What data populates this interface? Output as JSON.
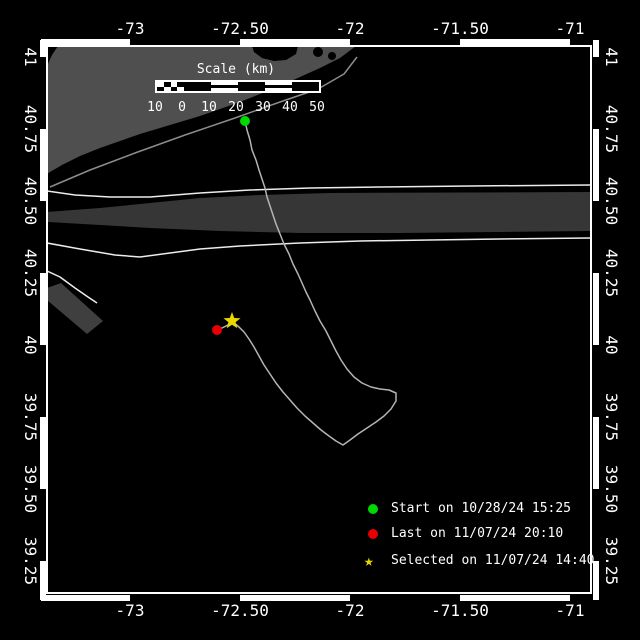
{
  "window": {
    "background": "#000000"
  },
  "colors": {
    "frame": "#ffffff",
    "text": "#ffffff",
    "land": "#4f4f4f",
    "coast_line": "#8c8c8c",
    "lane_band": "#363636",
    "approach_wedge": "#3f3f3f",
    "lane_line": "#ececec",
    "track": "#b4b4b4",
    "start": "#00d800",
    "last": "#e60000",
    "selected": "#e8d800"
  },
  "axes": {
    "lon_ticks": [
      {
        "label": "-73",
        "x": 130
      },
      {
        "label": "-72.50",
        "x": 240
      },
      {
        "label": "-72",
        "x": 350
      },
      {
        "label": "-71.50",
        "x": 460
      },
      {
        "label": "-71",
        "x": 570
      }
    ],
    "lat_ticks": [
      {
        "label": "41",
        "y": 57
      },
      {
        "label": "40.75",
        "y": 129
      },
      {
        "label": "40.50",
        "y": 201
      },
      {
        "label": "40.25",
        "y": 273
      },
      {
        "label": "40",
        "y": 345
      },
      {
        "label": "39.75",
        "y": 417
      },
      {
        "label": "39.50",
        "y": 489
      },
      {
        "label": "39.25",
        "y": 561
      }
    ],
    "zebra": {
      "lon_white": [
        [
          41,
          130
        ],
        [
          240,
          350
        ],
        [
          460,
          570
        ]
      ],
      "lat_white": [
        [
          40,
          57
        ],
        [
          129,
          201
        ],
        [
          273,
          345
        ],
        [
          417,
          489
        ],
        [
          561,
          600
        ]
      ]
    }
  },
  "scalebar": {
    "title": "Scale (km)",
    "x": 155,
    "title_y": 63,
    "bar_y": 80,
    "bar_h": 13,
    "seg_w": 27,
    "segments": [
      "checker",
      "black",
      "striped",
      "black",
      "striped",
      "black"
    ],
    "labels": [
      "10",
      "0",
      "10",
      "20",
      "30",
      "40",
      "50"
    ],
    "labels_y": 101
  },
  "legend": {
    "marker_x": 373,
    "label_x": 391,
    "items": [
      {
        "marker": "circle",
        "color_key": "start",
        "label": "Start on 10/28/24 15:25",
        "y": 509
      },
      {
        "marker": "circle",
        "color_key": "last",
        "label": "Last on 11/07/24 20:10",
        "y": 534
      },
      {
        "marker": "star",
        "color_key": "selected",
        "label": "Selected on 11/07/24 14:40",
        "y": 561
      }
    ]
  },
  "geometry": {
    "shapes": [
      {
        "name": "long-island-land",
        "type": "polygon",
        "fill": "land",
        "points": [
          [
            58,
            46
          ],
          [
            252,
            46
          ],
          [
            254,
            52
          ],
          [
            262,
            58
          ],
          [
            274,
            61
          ],
          [
            286,
            60
          ],
          [
            296,
            54
          ],
          [
            298,
            46
          ],
          [
            356,
            46
          ],
          [
            340,
            58
          ],
          [
            320,
            68
          ],
          [
            300,
            77
          ],
          [
            280,
            86
          ],
          [
            260,
            94
          ],
          [
            240,
            102
          ],
          [
            220,
            109
          ],
          [
            200,
            116
          ],
          [
            180,
            122
          ],
          [
            160,
            128
          ],
          [
            140,
            134
          ],
          [
            120,
            141
          ],
          [
            100,
            148
          ],
          [
            80,
            156
          ],
          [
            62,
            165
          ],
          [
            50,
            172
          ],
          [
            47,
            174
          ],
          [
            47,
            66
          ],
          [
            52,
            55
          ]
        ]
      },
      {
        "name": "bay-notch-1",
        "type": "circle",
        "fill": "#000000",
        "cx": 318,
        "cy": 52,
        "r": 5
      },
      {
        "name": "bay-notch-2",
        "type": "circle",
        "fill": "#000000",
        "cx": 332,
        "cy": 56,
        "r": 4
      },
      {
        "name": "barrier-island-line",
        "type": "polyline",
        "stroke": "coast_line",
        "w": 1.5,
        "points": [
          [
            50,
            187
          ],
          [
            90,
            170
          ],
          [
            135,
            153
          ],
          [
            185,
            135
          ],
          [
            235,
            118
          ],
          [
            280,
            102
          ],
          [
            318,
            89
          ],
          [
            344,
            74
          ],
          [
            357,
            57
          ]
        ]
      },
      {
        "name": "traffic-lane-band",
        "type": "polygon",
        "fill": "lane_band",
        "points": [
          [
            47,
            212
          ],
          [
            100,
            208
          ],
          [
            150,
            203
          ],
          [
            200,
            198
          ],
          [
            260,
            195
          ],
          [
            330,
            193
          ],
          [
            592,
            192
          ],
          [
            592,
            231
          ],
          [
            400,
            233
          ],
          [
            300,
            233
          ],
          [
            220,
            231
          ],
          [
            150,
            228
          ],
          [
            100,
            225
          ],
          [
            47,
            222
          ]
        ]
      },
      {
        "name": "approach-lane-wedge",
        "type": "polygon",
        "fill": "approach_wedge",
        "points": [
          [
            47,
            288
          ],
          [
            61,
            283
          ],
          [
            103,
            321
          ],
          [
            87,
            334
          ],
          [
            47,
            300
          ]
        ]
      },
      {
        "name": "lane-boundary-upper",
        "type": "polyline",
        "stroke": "lane_line",
        "w": 1.5,
        "points": [
          [
            47,
            191
          ],
          [
            75,
            195
          ],
          [
            110,
            197
          ],
          [
            150,
            197
          ],
          [
            200,
            193
          ],
          [
            250,
            190
          ],
          [
            310,
            188
          ],
          [
            380,
            187
          ],
          [
            470,
            186
          ],
          [
            592,
            185
          ]
        ]
      },
      {
        "name": "lane-boundary-lower",
        "type": "polyline",
        "stroke": "lane_line",
        "w": 1.5,
        "points": [
          [
            47,
            243
          ],
          [
            80,
            249
          ],
          [
            115,
            255
          ],
          [
            140,
            257
          ],
          [
            170,
            253
          ],
          [
            200,
            249
          ],
          [
            240,
            246
          ],
          [
            300,
            243
          ],
          [
            360,
            241
          ],
          [
            430,
            240
          ],
          [
            500,
            239
          ],
          [
            592,
            238
          ]
        ]
      },
      {
        "name": "approach-boundary-line",
        "type": "polyline",
        "stroke": "lane_line",
        "w": 1.5,
        "points": [
          [
            47,
            271
          ],
          [
            60,
            277
          ],
          [
            75,
            288
          ],
          [
            88,
            297
          ],
          [
            97,
            303
          ]
        ]
      },
      {
        "name": "drifter-track",
        "type": "polyline",
        "stroke": "track",
        "w": 1.5,
        "points": [
          [
            245,
            121
          ],
          [
            247,
            130
          ],
          [
            250,
            140
          ],
          [
            252,
            150
          ],
          [
            256,
            160
          ],
          [
            259,
            170
          ],
          [
            262,
            179
          ],
          [
            265,
            188
          ],
          [
            267,
            197
          ],
          [
            270,
            206
          ],
          [
            273,
            215
          ],
          [
            276,
            224
          ],
          [
            280,
            234
          ],
          [
            284,
            244
          ],
          [
            289,
            254
          ],
          [
            293,
            264
          ],
          [
            298,
            274
          ],
          [
            302,
            283
          ],
          [
            306,
            292
          ],
          [
            310,
            300
          ],
          [
            315,
            311
          ],
          [
            320,
            321
          ],
          [
            326,
            331
          ],
          [
            331,
            341
          ],
          [
            336,
            351
          ],
          [
            341,
            360
          ],
          [
            347,
            369
          ],
          [
            354,
            377
          ],
          [
            362,
            383
          ],
          [
            371,
            387
          ],
          [
            380,
            389
          ],
          [
            389,
            390
          ],
          [
            396,
            393
          ],
          [
            396,
            401
          ],
          [
            391,
            409
          ],
          [
            384,
            416
          ],
          [
            376,
            422
          ],
          [
            367,
            428
          ],
          [
            358,
            434
          ],
          [
            350,
            440
          ],
          [
            343,
            445
          ],
          [
            336,
            441
          ],
          [
            329,
            436
          ],
          [
            321,
            430
          ],
          [
            313,
            423
          ],
          [
            305,
            416
          ],
          [
            297,
            408
          ],
          [
            290,
            400
          ],
          [
            283,
            392
          ],
          [
            276,
            383
          ],
          [
            270,
            374
          ],
          [
            264,
            365
          ],
          [
            259,
            356
          ],
          [
            254,
            347
          ],
          [
            249,
            339
          ],
          [
            244,
            332
          ],
          [
            239,
            327
          ],
          [
            233,
            322
          ],
          [
            226,
            326
          ],
          [
            218,
            330
          ]
        ]
      }
    ],
    "markers": [
      {
        "name": "start-marker",
        "type": "circle",
        "x": 245,
        "y": 121,
        "r": 5,
        "color_key": "start"
      },
      {
        "name": "last-marker",
        "type": "circle",
        "x": 217,
        "y": 330,
        "r": 5,
        "color_key": "last"
      },
      {
        "name": "selected-marker",
        "type": "star",
        "x": 232,
        "y": 321,
        "r": 9,
        "color_key": "selected"
      }
    ]
  }
}
